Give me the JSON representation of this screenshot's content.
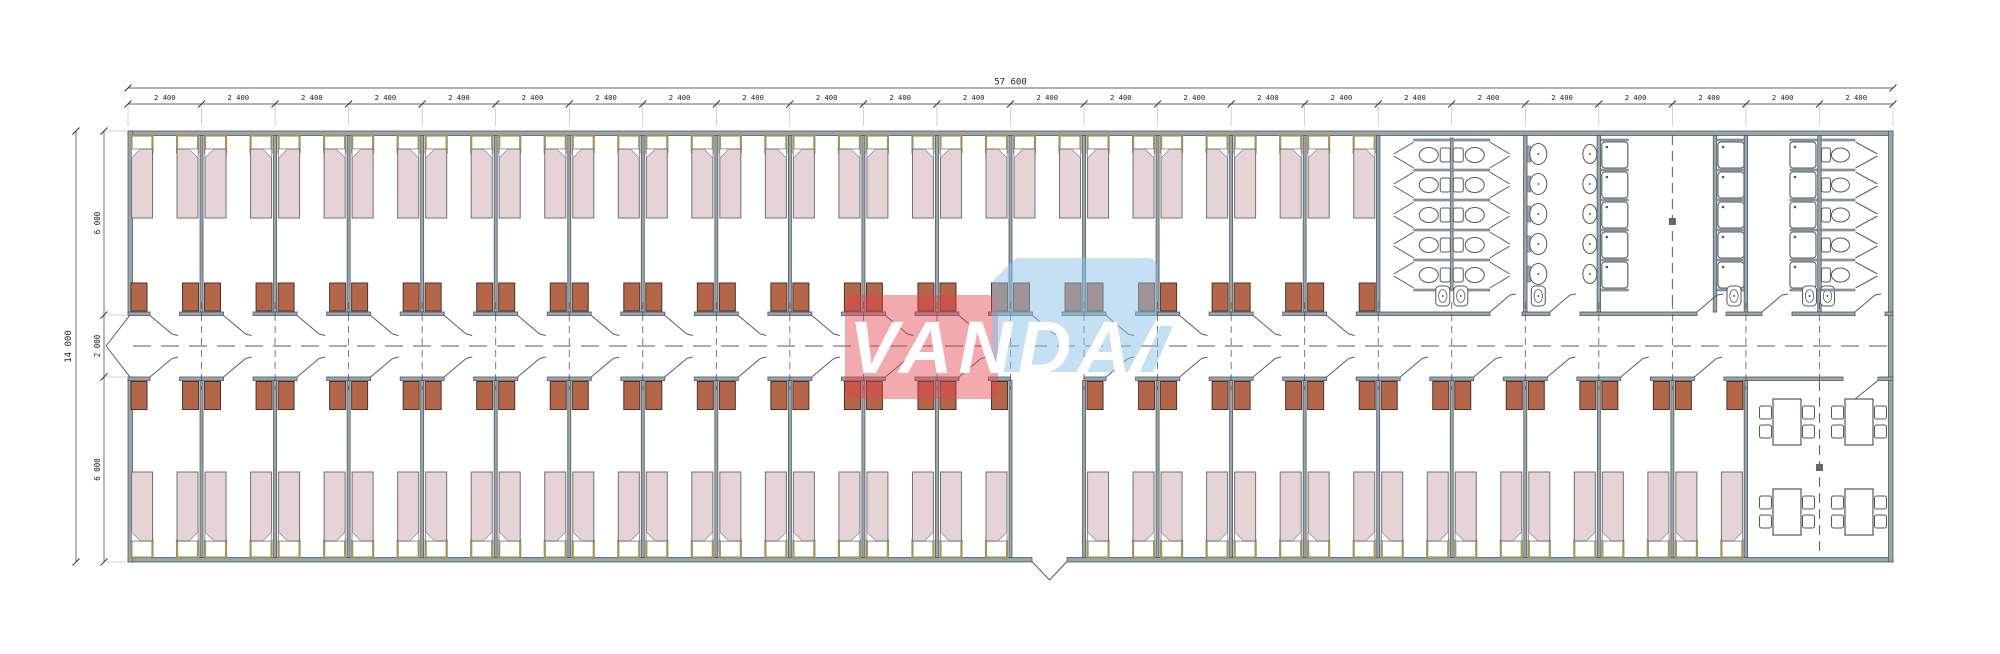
{
  "drawing": {
    "title": "Dormitory container building floor plan",
    "watermark": {
      "text": "VANDA",
      "red_color": "rgba(229,66,76,0.45)",
      "blue_color": "rgba(139,193,230,0.50)",
      "text_color": "#ffffff"
    },
    "dimensions": {
      "overall_width_label": "57 600",
      "module_width_label": "2 400",
      "module_count": 24,
      "overall_height_label": "14 000",
      "height_segment_labels": [
        "6 000",
        "2 000",
        "6 000"
      ]
    },
    "counts": {
      "top_rooms": 17,
      "bottom_rooms": 22,
      "entrance_module_index": 12,
      "beds_per_room": 2,
      "wc_stall_rows": 5,
      "washbasins": 5,
      "urinals": 5,
      "shower_columns": 3,
      "showers_per_column": 5,
      "right_wc_stalls": 5,
      "dining_tables": 4,
      "chairs_per_table": 4
    },
    "colors": {
      "wall_fill": "#9aa4ac",
      "wall_edge": "#4f5a63",
      "line": "#555e66",
      "bed_fill": "#e6d3d6",
      "bed_edge": "#707070",
      "pillow_edge": "#a2955c",
      "cabinet_fill": "#b4664b",
      "cabinet_edge": "#503125",
      "fixture_fill": "#ffffff",
      "dash_color": "#5a5a5a",
      "dim_color": "#333333"
    }
  }
}
